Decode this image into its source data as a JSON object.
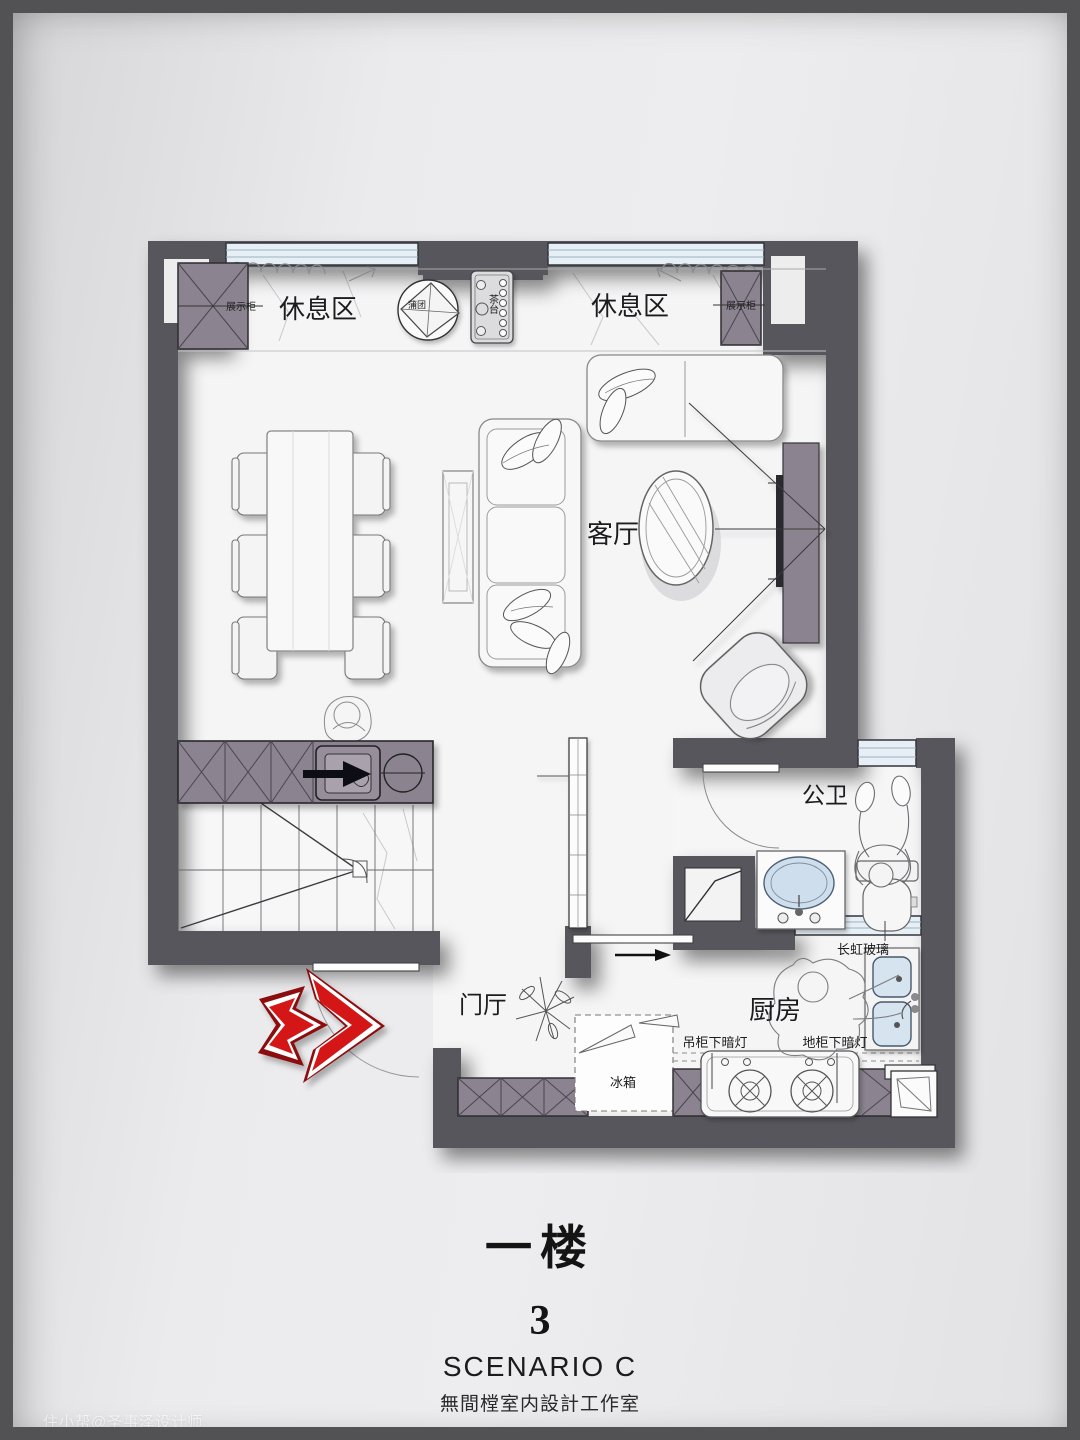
{
  "footer": {
    "floor_label": "一楼",
    "page_number": "3",
    "scenario": "SCENARIO C",
    "studio": "無間樘室内設計工作室"
  },
  "watermark": "住小帮@圣事泽设计师",
  "rooms": {
    "rest_area_left": "休息区",
    "rest_area_right": "休息区",
    "living_room": "客厅",
    "bathroom": "公卫",
    "foyer": "门厅",
    "kitchen": "厨房"
  },
  "annotations": {
    "display_cabinet_left": "展示柜",
    "display_cabinet_right": "展示柜",
    "meditation_cushion": "蒲团",
    "tea_table": "茶台",
    "fridge": "冰箱",
    "wall_cabinet_light": "吊柜下暗灯",
    "base_cabinet_light": "地柜下暗灯",
    "reeded_glass": "长虹玻璃"
  },
  "colors": {
    "wall": "#57575b",
    "cabinet": "#8b8490",
    "window_glass": "#e7eff6",
    "floor": "#f5f5f6",
    "arrow_red": "#d41418",
    "arrow_red_dark": "#8c0e11",
    "background": "#e9e9eb",
    "frame": "#525255"
  }
}
